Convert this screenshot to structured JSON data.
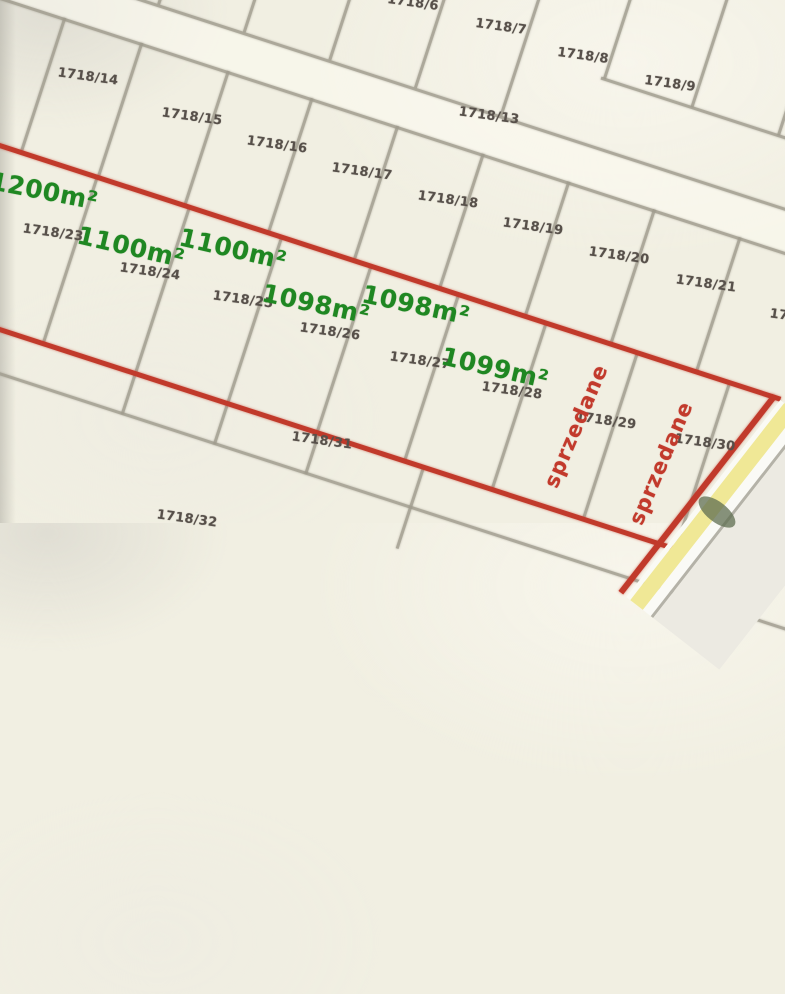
{
  "map_title": "Cadastral parcel map with plot areas",
  "colors": {
    "background_beige": "#f1efe2",
    "boundary_gray": "#a09c8e",
    "boundary_red": "#c13a2b",
    "parcel_number_text": "#57504a",
    "area_text_green": "#1f8722",
    "sold_text_red": "#c23a2c",
    "highway_yellow": "#f0e896"
  },
  "parcel_labels": [
    {
      "text": "1718/6",
      "x": 413,
      "y": 3,
      "rot": 8
    },
    {
      "text": "1718/7",
      "x": 501,
      "y": 27,
      "rot": 8
    },
    {
      "text": "1718/8",
      "x": 583,
      "y": 56,
      "rot": 8
    },
    {
      "text": "1718/9",
      "x": 670,
      "y": 84,
      "rot": 8
    },
    {
      "text": "1718/13",
      "x": 489,
      "y": 116,
      "rot": 8
    },
    {
      "text": "1718/14",
      "x": 88,
      "y": 77,
      "rot": 8
    },
    {
      "text": "1718/15",
      "x": 192,
      "y": 117,
      "rot": 8
    },
    {
      "text": "1718/16",
      "x": 277,
      "y": 145,
      "rot": 8
    },
    {
      "text": "1718/17",
      "x": 362,
      "y": 172,
      "rot": 8
    },
    {
      "text": "1718/18",
      "x": 448,
      "y": 200,
      "rot": 8
    },
    {
      "text": "1718/19",
      "x": 533,
      "y": 227,
      "rot": 8
    },
    {
      "text": "1718/20",
      "x": 619,
      "y": 256,
      "rot": 8
    },
    {
      "text": "1718/21",
      "x": 706,
      "y": 284,
      "rot": 8
    },
    {
      "text": "1718/22",
      "x": 800,
      "y": 318,
      "rot": 8
    },
    {
      "text": "1718/23",
      "x": 53,
      "y": 233,
      "rot": 8
    },
    {
      "text": "1718/24",
      "x": 150,
      "y": 272,
      "rot": 8
    },
    {
      "text": "1718/25",
      "x": 243,
      "y": 300,
      "rot": 8
    },
    {
      "text": "1718/26",
      "x": 330,
      "y": 332,
      "rot": 8
    },
    {
      "text": "1718/27",
      "x": 420,
      "y": 361,
      "rot": 8
    },
    {
      "text": "1718/28",
      "x": 512,
      "y": 391,
      "rot": 8
    },
    {
      "text": "1718/29",
      "x": 606,
      "y": 421,
      "rot": 8
    },
    {
      "text": "1718/30",
      "x": 705,
      "y": 443,
      "rot": 8
    },
    {
      "text": "1718/31",
      "x": 322,
      "y": 441,
      "rot": 8
    },
    {
      "text": "1718/32",
      "x": 187,
      "y": 519,
      "rot": 8
    }
  ],
  "area_labels": [
    {
      "text": "1200m²",
      "x": 44,
      "y": 191,
      "rot": 11
    },
    {
      "text": "1100m²",
      "x": 131,
      "y": 247,
      "rot": 13
    },
    {
      "text": "1100m²",
      "x": 233,
      "y": 249,
      "rot": 13
    },
    {
      "text": "1098m²",
      "x": 316,
      "y": 304,
      "rot": 12
    },
    {
      "text": "1098m²",
      "x": 416,
      "y": 305,
      "rot": 12
    },
    {
      "text": "1099m²",
      "x": 495,
      "y": 368,
      "rot": 13
    }
  ],
  "sold_labels": [
    {
      "text": "sprzedane",
      "x": 576,
      "y": 426,
      "rot": -67
    },
    {
      "text": "sprzedane",
      "x": 661,
      "y": 463,
      "rot": -67
    }
  ]
}
